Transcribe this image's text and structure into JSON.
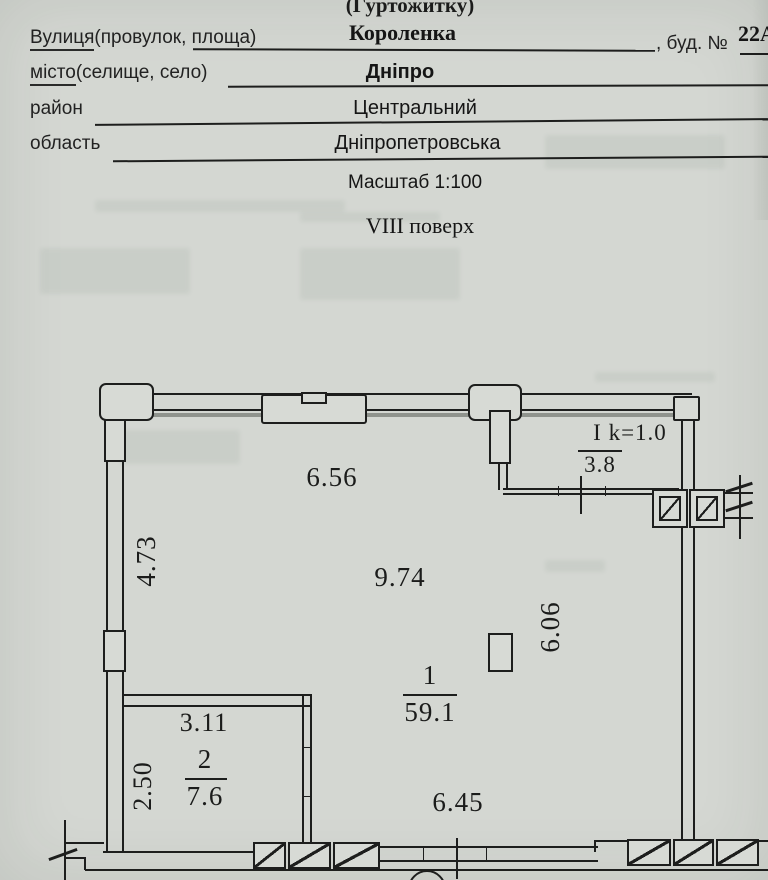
{
  "form": {
    "title_partial": "(Гуртожитку)",
    "street": {
      "label_word": "Вулиця",
      "label_rest": "(провулок, площа)",
      "value": "Короленка"
    },
    "building": {
      "label": ", буд. №",
      "value": "22А"
    },
    "city": {
      "label_word": "місто",
      "label_rest": "(селище, село)",
      "value": "Дніпро"
    },
    "district": {
      "label": "район",
      "value": "Центральний"
    },
    "region": {
      "label": "область",
      "value": "Дніпропетровська"
    },
    "scale_text": "Масштаб 1:100",
    "floor_text": "VIII  поверх"
  },
  "plan": {
    "dims": {
      "top_window": "6.56",
      "room1_length": "9.74",
      "left_wall": "4.73",
      "room1_width": "6.06",
      "bottom": "6.45",
      "room2_width": "3.11",
      "room2_depth": "2.50"
    },
    "rooms": {
      "room1": {
        "number": "1",
        "area": "59.1"
      },
      "room2": {
        "number": "2",
        "area": "7.6"
      }
    },
    "loggia": {
      "label": "I k=1.0",
      "area": "3.8"
    }
  }
}
